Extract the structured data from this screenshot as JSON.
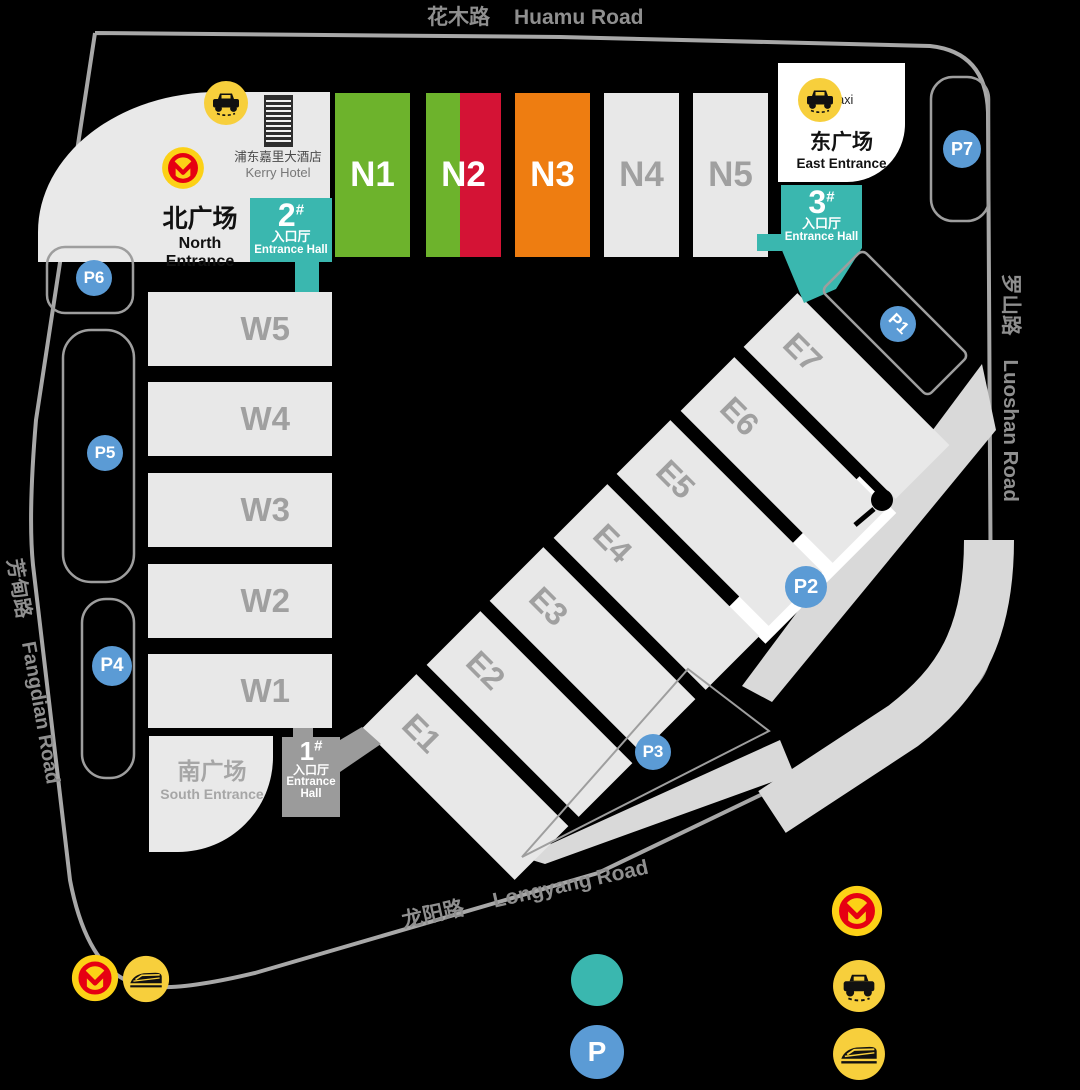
{
  "roads": {
    "huamu": {
      "cn": "花木路",
      "en": "Huamu Road"
    },
    "luoshan": {
      "cn": "罗山路",
      "en": "Luoshan Road"
    },
    "fangdian": {
      "cn": "芳甸路",
      "en": "Fangdian Road"
    },
    "longyang": {
      "cn": "龙阳路",
      "en": "Longyang Road"
    }
  },
  "halls": {
    "n": [
      "N1",
      "N2",
      "N3",
      "N4",
      "N5"
    ],
    "w": [
      "W5",
      "W4",
      "W3",
      "W2",
      "W1"
    ],
    "e": [
      "E1",
      "E2",
      "E3",
      "E4",
      "E5",
      "E6",
      "E7"
    ]
  },
  "plazas": {
    "north": {
      "cn": "北广场",
      "en1": "North",
      "en2": "Entrance"
    },
    "east": {
      "cn": "东广场",
      "en": "East Entrance"
    },
    "south": {
      "cn": "南广场",
      "en": "South Entrance"
    }
  },
  "entrance_halls": {
    "h1": {
      "num": "1",
      "hash": "#",
      "cn": "入口厅",
      "en1": "Entrance",
      "en2": "Hall"
    },
    "h2": {
      "num": "2",
      "hash": "#",
      "cn": "入口厅",
      "en": "Entrance Hall"
    },
    "h3": {
      "num": "3",
      "hash": "#",
      "cn": "入口厅",
      "en": "Entrance Hall"
    }
  },
  "hotel": {
    "cn": "浦东嘉里大酒店",
    "en": "Kerry Hotel"
  },
  "labels": {
    "taxi": "Taxi"
  },
  "parking": [
    "P1",
    "P2",
    "P3",
    "P4",
    "P5",
    "P6",
    "P7"
  ],
  "legend": {
    "p": "P"
  },
  "colors": {
    "hall_green": "#6db32c",
    "hall_red": "#d41335",
    "hall_orange": "#ee7d11",
    "hall_gray": "#e8e8e8",
    "entrance_teal": "#3ab7af",
    "entrance_gray": "#9b9b9b",
    "parking_blue": "#5b9bd5",
    "icon_yellow": "#f7cf3c",
    "metro_red": "#e60012",
    "road_gray": "#a8a8a8"
  }
}
